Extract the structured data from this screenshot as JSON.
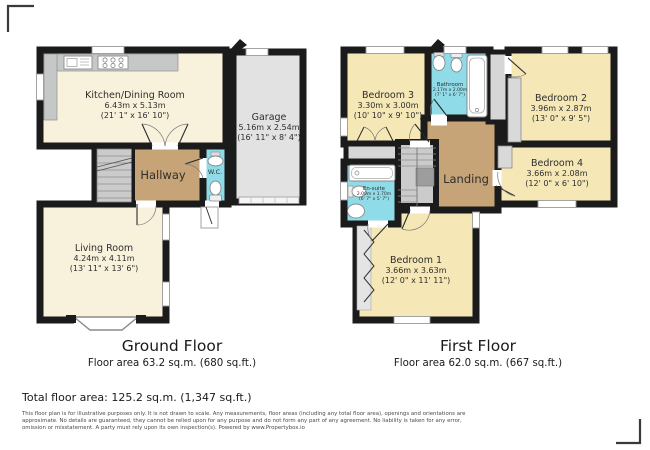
{
  "colors": {
    "wall": "#1b1b1b",
    "floor_cream": "#F8F1DC",
    "bedroom_yellow": "#F5E8B6",
    "hall_tan": "#C7A478",
    "wet_cyan": "#8FDCE8",
    "garage_gray": "#E2E2E2",
    "stairs_gray": "#CBCBCB",
    "counter_gray": "#C6C8C8"
  },
  "ground_floor": {
    "title": "Ground Floor",
    "area": "Floor area 63.2 sq.m. (680 sq.ft.)",
    "rooms": {
      "kitchen": {
        "name": "Kitchen/Dining Room",
        "metric": "6.43m x 5.13m",
        "imperial": "(21' 1\" x 16' 10\")"
      },
      "garage": {
        "name": "Garage",
        "metric": "5.16m x 2.54m",
        "imperial": "(16' 11\" x 8' 4\")"
      },
      "hallway": {
        "name": "Hallway"
      },
      "wc": {
        "name": "W.C."
      },
      "living": {
        "name": "Living Room",
        "metric": "4.24m x 4.11m",
        "imperial": "(13' 11\" x 13' 6\")"
      }
    }
  },
  "first_floor": {
    "title": "First Floor",
    "area": "Floor area 62.0 sq.m. (667 sq.ft.)",
    "rooms": {
      "bedroom3": {
        "name": "Bedroom 3",
        "metric": "3.30m x 3.00m",
        "imperial": "(10' 10\" x 9' 10\")"
      },
      "bathroom": {
        "name": "Bathroom",
        "metric": "2.17m x 2.00m",
        "imperial": "(7' 1\" x 6' 7\")"
      },
      "bedroom2": {
        "name": "Bedroom 2",
        "metric": "3.96m x 2.87m",
        "imperial": "(13' 0\" x 9' 5\")"
      },
      "bedroom4": {
        "name": "Bedroom 4",
        "metric": "3.66m x 2.08m",
        "imperial": "(12' 0\" x 6' 10\")"
      },
      "landing": {
        "name": "Landing"
      },
      "ensuite": {
        "name": "En-suite",
        "metric": "2.00m x 1.70m",
        "imperial": "(6' 7\" x 5' 7\")"
      },
      "bedroom1": {
        "name": "Bedroom 1",
        "metric": "3.66m x 3.63m",
        "imperial": "(12' 0\" x 11' 11\")"
      }
    }
  },
  "footer": {
    "total": "Total floor area: 125.2 sq.m. (1,347 sq.ft.)",
    "disclaimer": [
      "This floor plan is for illustrative purposes only. It is not drawn to scale. Any measurements, floor areas (including any total floor area), openings and orientations are",
      "approximate. No details are guaranteed, they cannot be relied upon for any purpose and do not form any part of any agreement. No liability is taken for any error,",
      "omission or misstatement. A party must rely upon its own inspection(s). Powered by www.Propertybox.io"
    ]
  }
}
